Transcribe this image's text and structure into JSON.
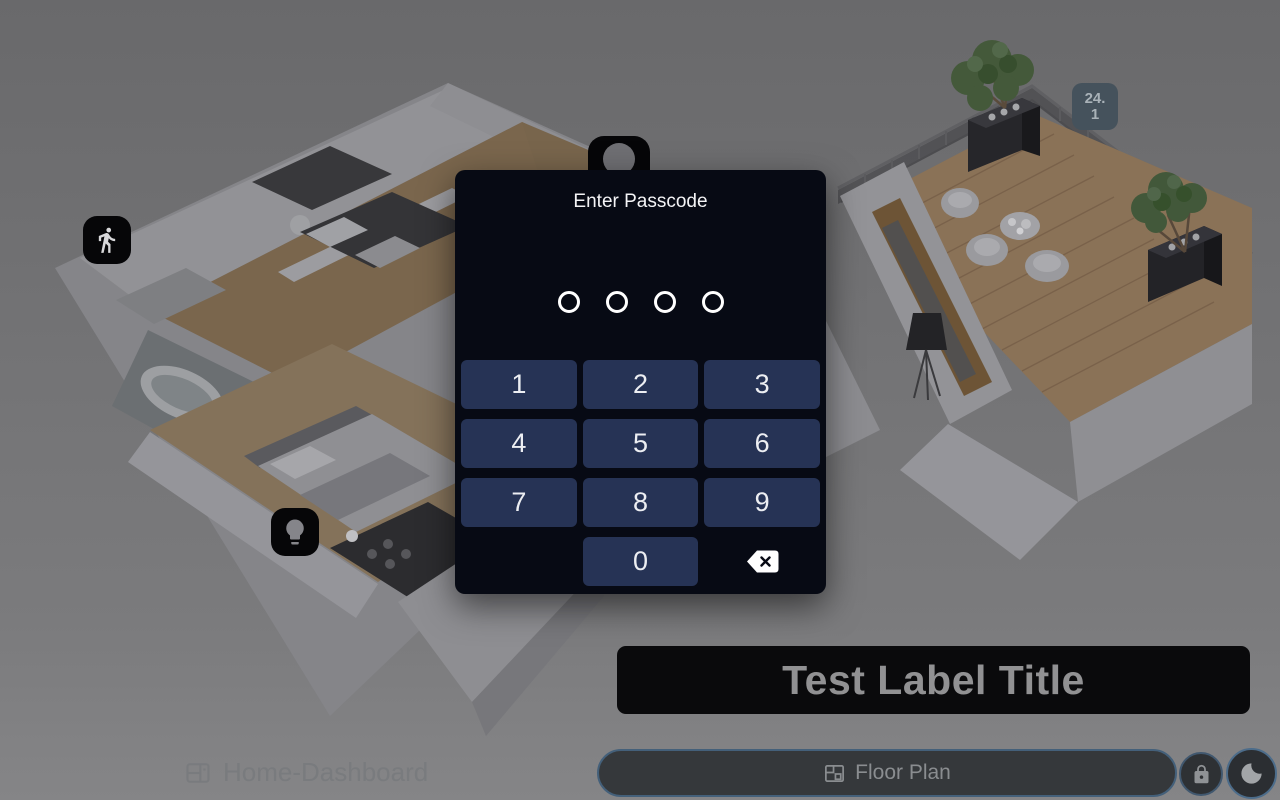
{
  "passcode_dialog": {
    "title": "Enter Passcode",
    "dots": 4,
    "keys": [
      "1",
      "2",
      "3",
      "4",
      "5",
      "6",
      "7",
      "8",
      "9",
      "0"
    ]
  },
  "floorplan_overlay": {
    "temperature_badge": "24.1",
    "label_title": "Test Label Title"
  },
  "bottom_bar": {
    "dashboard_label": "Home-Dashboard",
    "view_selector": "Floor Plan"
  },
  "icons": {
    "motion": "walking-person-icon",
    "presence": "person-icon",
    "light": "lightbulb-icon",
    "backspace": "backspace-icon",
    "dashboard": "dashboard-icon",
    "floorplan": "floorplan-icon",
    "lock": "lock-icon",
    "night": "moon-icon"
  },
  "colors": {
    "dialog_bg": "#070a14",
    "keypad_button": "#263355",
    "badge_bg": "#45525c",
    "accent_border": "#4c6c8a",
    "label_box_bg": "#0a0a0c"
  }
}
